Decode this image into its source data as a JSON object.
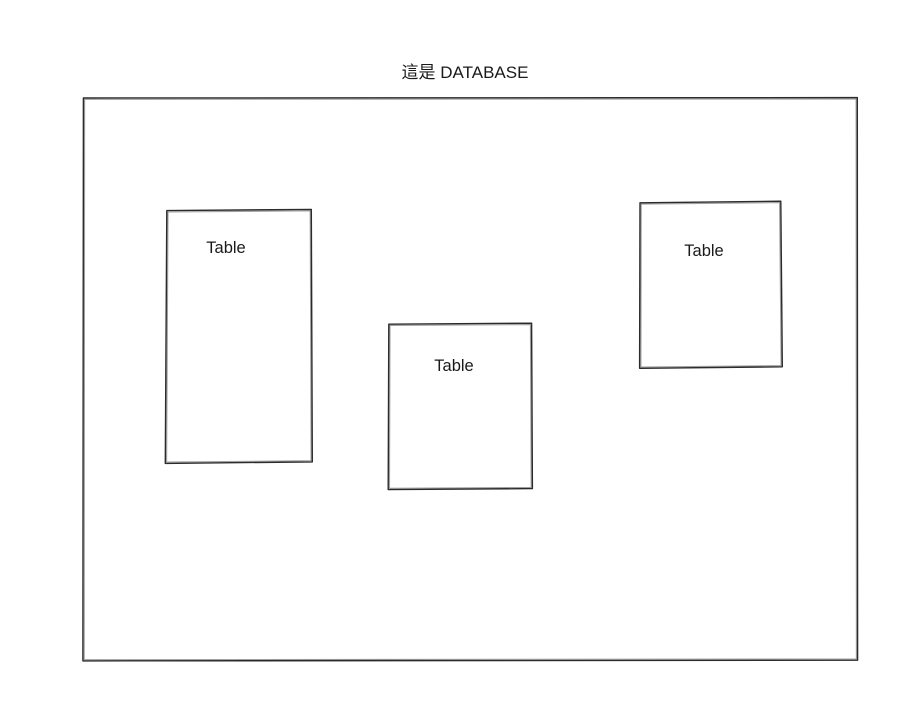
{
  "canvas": {
    "width": 916,
    "height": 728,
    "background": "#ffffff"
  },
  "diagram": {
    "title": "這是 DATABASE",
    "stroke_color": "#2b2b2b",
    "text_color": "#1a1a1a",
    "tables": [
      {
        "label": "Table"
      },
      {
        "label": "Table"
      },
      {
        "label": "Table"
      }
    ]
  }
}
